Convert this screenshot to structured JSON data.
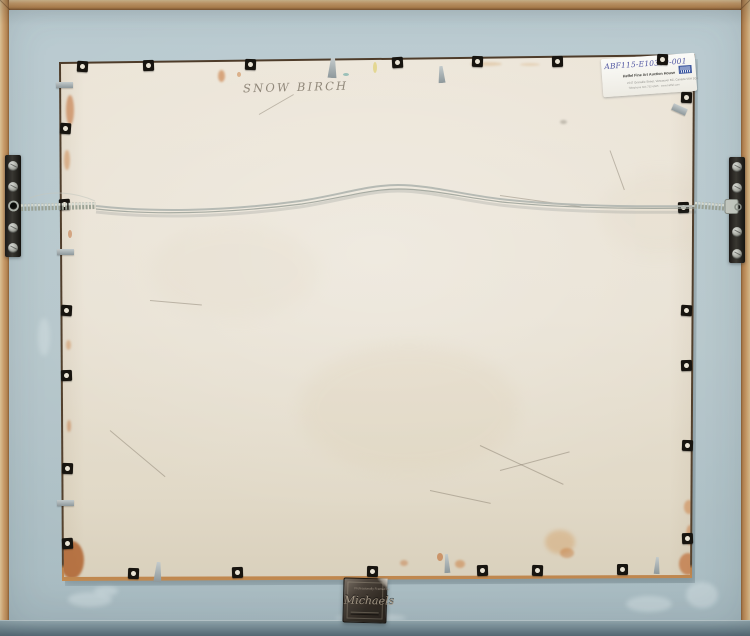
{
  "artwork": {
    "handwritten_title": "SNOW BIRCH"
  },
  "auction_label": {
    "code": "ABF115-E10309-001",
    "company": "Heffel Fine Art Auction House",
    "address": "2247 Granville Street, Vancouver BC, Canada V6H 3G1",
    "contact": "Telephone 604 732-6505 · www.heffel.com"
  },
  "framer_plaque": {
    "line1": "Professionally Framed by",
    "line2": "Michaels"
  },
  "colors": {
    "frame_wood": "#c6925e",
    "mat": "#b4c5ca",
    "panel": "#e7e1d4",
    "wire": "#b6bab4",
    "bracket": "#26221e",
    "plaque": "#3a332c",
    "label_ink": "#5056a2"
  }
}
